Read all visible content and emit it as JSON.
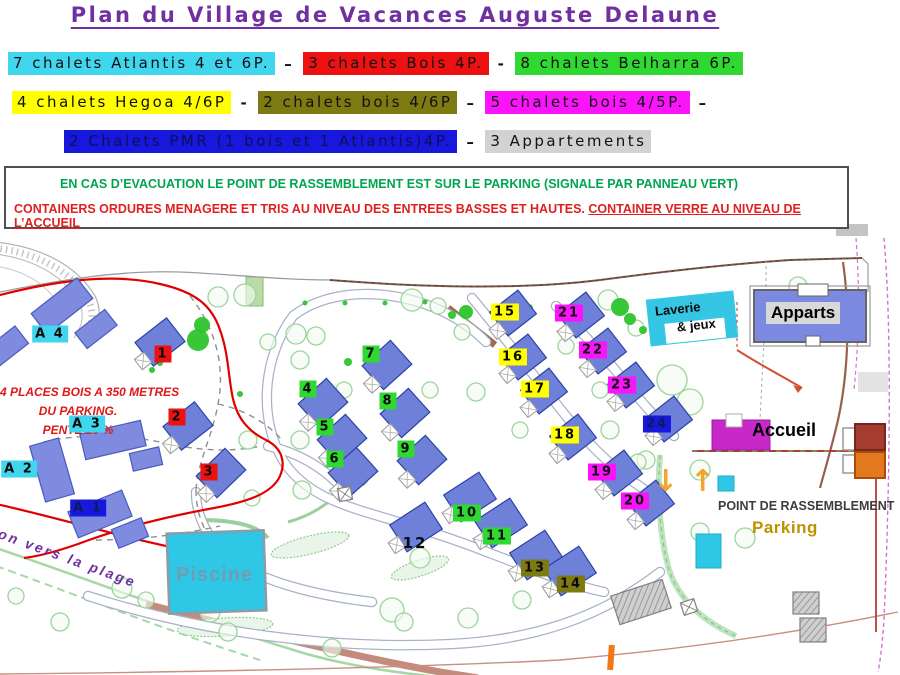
{
  "title": "Plan du Village de Vacances Auguste Delaune",
  "legend": {
    "rows": [
      [
        {
          "text": "7 chalets Atlantis 4 et 6P.",
          "bg": "cyan"
        },
        {
          "text": "–",
          "bg": "none"
        },
        {
          "text": "3 chalets Bois 4P.",
          "bg": "red"
        },
        {
          "text": "-",
          "bg": "none"
        },
        {
          "text": "8 chalets Belharra 6P.",
          "bg": "green"
        }
      ],
      [
        {
          "text": "4 chalets Hegoa 4/6P",
          "bg": "yellow"
        },
        {
          "text": "-",
          "bg": "none"
        },
        {
          "text": "2 chalets bois 4/6P",
          "bg": "olive"
        },
        {
          "text": "–",
          "bg": "none"
        },
        {
          "text": "5 chalets bois 4/5P.",
          "bg": "magenta"
        },
        {
          "text": "–",
          "bg": "none"
        }
      ],
      [
        {
          "text": "2 Chalets PMR (1 bois et 1 Atlantis)4P.",
          "bg": "blue",
          "fg": "#0E0E5A"
        },
        {
          "text": "–",
          "bg": "none"
        },
        {
          "text": "3 Appartements",
          "bg": "gray"
        }
      ]
    ]
  },
  "notice": {
    "green": "EN CAS D’EVACUATION LE POINT DE RASSEMBLEMENT EST SUR LE PARKING (SIGNALE PAR PANNEAU VERT)",
    "red_main": "CONTAINERS ORDURES MENAGERE ET TRIS AU NIVEAU DES ENTREES BASSES ET HAUTES. ",
    "red_underlined": "CONTAINER VERRE AU NIVEAU DE L’ACCUEIL"
  },
  "map": {
    "labels": {
      "four_places_1": "4 PLACES BOIS A 350 METRES",
      "four_places_2": "DU PARKING.",
      "four_places_3": "PENTE 20 %",
      "plage": "ton vers la plage",
      "piscine": "Piscine",
      "accueil": "Accueil",
      "apparts": "Apparts",
      "laverie_line1": "Laverie",
      "laverie_line2": "& jeux",
      "rassemblement": "POINT DE RASSEMBLEMENT",
      "parking": "Parking",
      "arrow_down": "↓",
      "arrow_up": "↑"
    },
    "markers": [
      {
        "t": "1",
        "x": 163,
        "y": 354,
        "c": "red"
      },
      {
        "t": "2",
        "x": 177,
        "y": 417,
        "c": "red"
      },
      {
        "t": "3",
        "x": 209,
        "y": 472,
        "c": "red"
      },
      {
        "t": "4",
        "x": 308,
        "y": 389,
        "c": "green"
      },
      {
        "t": "5",
        "x": 325,
        "y": 427,
        "c": "green"
      },
      {
        "t": "6",
        "x": 335,
        "y": 459,
        "c": "green"
      },
      {
        "t": "7",
        "x": 371,
        "y": 354,
        "c": "green"
      },
      {
        "t": "8",
        "x": 388,
        "y": 401,
        "c": "green"
      },
      {
        "t": "9",
        "x": 406,
        "y": 449,
        "c": "green"
      },
      {
        "t": "10",
        "x": 467,
        "y": 513,
        "c": "green"
      },
      {
        "t": "11",
        "x": 497,
        "y": 536,
        "c": "green"
      },
      {
        "t": "12",
        "x": 415,
        "y": 543,
        "c": "none"
      },
      {
        "t": "13",
        "x": 535,
        "y": 568,
        "c": "olive"
      },
      {
        "t": "14",
        "x": 571,
        "y": 584,
        "c": "olive"
      },
      {
        "t": "15",
        "x": 505,
        "y": 312,
        "c": "yellow"
      },
      {
        "t": "16",
        "x": 513,
        "y": 357,
        "c": "yellow"
      },
      {
        "t": "17",
        "x": 535,
        "y": 389,
        "c": "yellow"
      },
      {
        "t": "18",
        "x": 565,
        "y": 435,
        "c": "yellow"
      },
      {
        "t": "19",
        "x": 602,
        "y": 472,
        "c": "magenta"
      },
      {
        "t": "20",
        "x": 635,
        "y": 501,
        "c": "magenta"
      },
      {
        "t": "21",
        "x": 569,
        "y": 313,
        "c": "magenta"
      },
      {
        "t": "22",
        "x": 593,
        "y": 350,
        "c": "magenta"
      },
      {
        "t": "23",
        "x": 622,
        "y": 385,
        "c": "magenta"
      },
      {
        "t": "24",
        "x": 657,
        "y": 424,
        "c": "blue"
      },
      {
        "t": "A 4",
        "x": 50,
        "y": 334,
        "c": "cyan"
      },
      {
        "t": "A 3",
        "x": 87,
        "y": 424,
        "c": "cyan"
      },
      {
        "t": "A 2",
        "x": 19,
        "y": 469,
        "c": "cyan"
      },
      {
        "t": "A 1",
        "x": 88,
        "y": 508,
        "c": "blue"
      }
    ],
    "buildings": [
      [
        62,
        306,
        58,
        26,
        -38,
        "a"
      ],
      [
        96,
        329,
        38,
        20,
        -38,
        "a"
      ],
      [
        6,
        347,
        40,
        22,
        -38,
        "a"
      ],
      [
        113,
        440,
        62,
        26,
        -13,
        "a"
      ],
      [
        146,
        459,
        30,
        18,
        -13,
        "a"
      ],
      [
        52,
        470,
        30,
        58,
        -16,
        "a"
      ],
      [
        100,
        514,
        58,
        28,
        -22,
        "a"
      ],
      [
        130,
        533,
        32,
        20,
        -22,
        "a"
      ],
      [
        160,
        342,
        40,
        30,
        -38,
        "c"
      ],
      [
        188,
        426,
        40,
        30,
        -38,
        "c"
      ],
      [
        221,
        473,
        40,
        30,
        -44,
        "c"
      ],
      [
        323,
        403,
        38,
        32,
        -42,
        "c"
      ],
      [
        342,
        439,
        38,
        32,
        -42,
        "c"
      ],
      [
        353,
        472,
        38,
        32,
        -42,
        "c"
      ],
      [
        387,
        365,
        38,
        32,
        -42,
        "c"
      ],
      [
        405,
        413,
        38,
        32,
        -42,
        "c"
      ],
      [
        422,
        460,
        38,
        32,
        -42,
        "c"
      ],
      [
        470,
        497,
        42,
        32,
        -33,
        "c"
      ],
      [
        501,
        523,
        42,
        32,
        -33,
        "c"
      ],
      [
        416,
        527,
        42,
        32,
        -33,
        "c"
      ],
      [
        536,
        555,
        42,
        32,
        -33,
        "c"
      ],
      [
        570,
        571,
        42,
        32,
        -33,
        "c"
      ],
      [
        513,
        313,
        36,
        30,
        -38,
        "c"
      ],
      [
        523,
        357,
        36,
        30,
        -38,
        "c"
      ],
      [
        544,
        391,
        36,
        30,
        -38,
        "c"
      ],
      [
        573,
        437,
        36,
        30,
        -38,
        "c"
      ],
      [
        619,
        473,
        36,
        30,
        -38,
        "c"
      ],
      [
        651,
        503,
        36,
        30,
        -38,
        "c"
      ],
      [
        581,
        315,
        36,
        30,
        -38,
        "c"
      ],
      [
        603,
        351,
        36,
        30,
        -38,
        "c"
      ],
      [
        631,
        385,
        36,
        30,
        -38,
        "c"
      ],
      [
        669,
        419,
        36,
        30,
        -38,
        "c"
      ],
      [
        641,
        602,
        54,
        30,
        -18,
        "g"
      ],
      [
        806,
        603,
        26,
        22,
        0,
        "g"
      ],
      [
        813,
        630,
        26,
        24,
        0,
        "g"
      ],
      [
        689,
        607,
        14,
        13,
        -18,
        "x"
      ],
      [
        345,
        494,
        13,
        13,
        -10,
        "x"
      ]
    ],
    "trees": [
      [
        245,
        295,
        11
      ],
      [
        218,
        297,
        10
      ],
      [
        268,
        342,
        8
      ],
      [
        296,
        334,
        10
      ],
      [
        316,
        336,
        9
      ],
      [
        412,
        300,
        11
      ],
      [
        438,
        306,
        8
      ],
      [
        300,
        360,
        9
      ],
      [
        344,
        390,
        8
      ],
      [
        300,
        440,
        9
      ],
      [
        248,
        440,
        9
      ],
      [
        360,
        478,
        8
      ],
      [
        302,
        490,
        9
      ],
      [
        252,
        498,
        8
      ],
      [
        430,
        390,
        8
      ],
      [
        476,
        392,
        9
      ],
      [
        520,
        430,
        8
      ],
      [
        610,
        430,
        9
      ],
      [
        646,
        460,
        9
      ],
      [
        700,
        470,
        10
      ],
      [
        672,
        380,
        15
      ],
      [
        690,
        402,
        13
      ],
      [
        745,
        538,
        10
      ],
      [
        700,
        532,
        9
      ],
      [
        420,
        558,
        10
      ],
      [
        392,
        610,
        12
      ],
      [
        404,
        622,
        9
      ],
      [
        468,
        618,
        10
      ],
      [
        522,
        600,
        9
      ],
      [
        122,
        588,
        10
      ],
      [
        146,
        600,
        8
      ],
      [
        210,
        612,
        10
      ],
      [
        228,
        632,
        9
      ],
      [
        332,
        648,
        9
      ],
      [
        60,
        622,
        9
      ],
      [
        16,
        596,
        8
      ],
      [
        382,
        356,
        7
      ],
      [
        462,
        332,
        8
      ],
      [
        608,
        300,
        10
      ],
      [
        636,
        328,
        8
      ],
      [
        566,
        346,
        8
      ],
      [
        600,
        390,
        8
      ],
      [
        638,
        462,
        8
      ],
      [
        798,
        286,
        9
      ],
      [
        848,
        300,
        7
      ]
    ],
    "blobs": [
      [
        202,
        325,
        8
      ],
      [
        198,
        340,
        11
      ],
      [
        620,
        307,
        9
      ],
      [
        630,
        319,
        6
      ],
      [
        698,
        313,
        6
      ],
      [
        466,
        312,
        7
      ],
      [
        452,
        315,
        4
      ],
      [
        643,
        330,
        4
      ],
      [
        85,
        421,
        6
      ],
      [
        305,
        303,
        2.5
      ],
      [
        345,
        303,
        2.5
      ],
      [
        385,
        303,
        2.5
      ],
      [
        425,
        302,
        2.5
      ],
      [
        146,
        359,
        3
      ],
      [
        160,
        363,
        3
      ],
      [
        152,
        370,
        3
      ],
      [
        348,
        362,
        4
      ],
      [
        240,
        394,
        3
      ],
      [
        518,
        303,
        5
      ],
      [
        529,
        308,
        4
      ]
    ]
  },
  "colors": {
    "title": "#7030A0",
    "notice_green": "#00A550",
    "notice_red": "#E02020",
    "chips": {
      "cyan": "#3FD6EE",
      "red": "#EE1111",
      "green": "#2FD932",
      "yellow": "#FFFF00",
      "olive": "#7E7A12",
      "magenta": "#FA14FA",
      "blue": "#1818DC",
      "gray": "#D2D2D2",
      "none": "transparent"
    },
    "chip_fg": {
      "blue": "#0A1C5C"
    },
    "map_accents": {
      "pool": "#2EC7E6",
      "chalet_building": "#6E80D8",
      "atlantis_building": "#7E8BDE",
      "accueil_building": "#C928C9",
      "container_red": "#A63B30",
      "container_orange": "#E2791F",
      "parking_text": "#BF9000",
      "arrow": "#F2A431",
      "plage_text": "#7030A0",
      "note_red": "#E01818",
      "evacuation_zone_outline": "#E00000"
    }
  }
}
